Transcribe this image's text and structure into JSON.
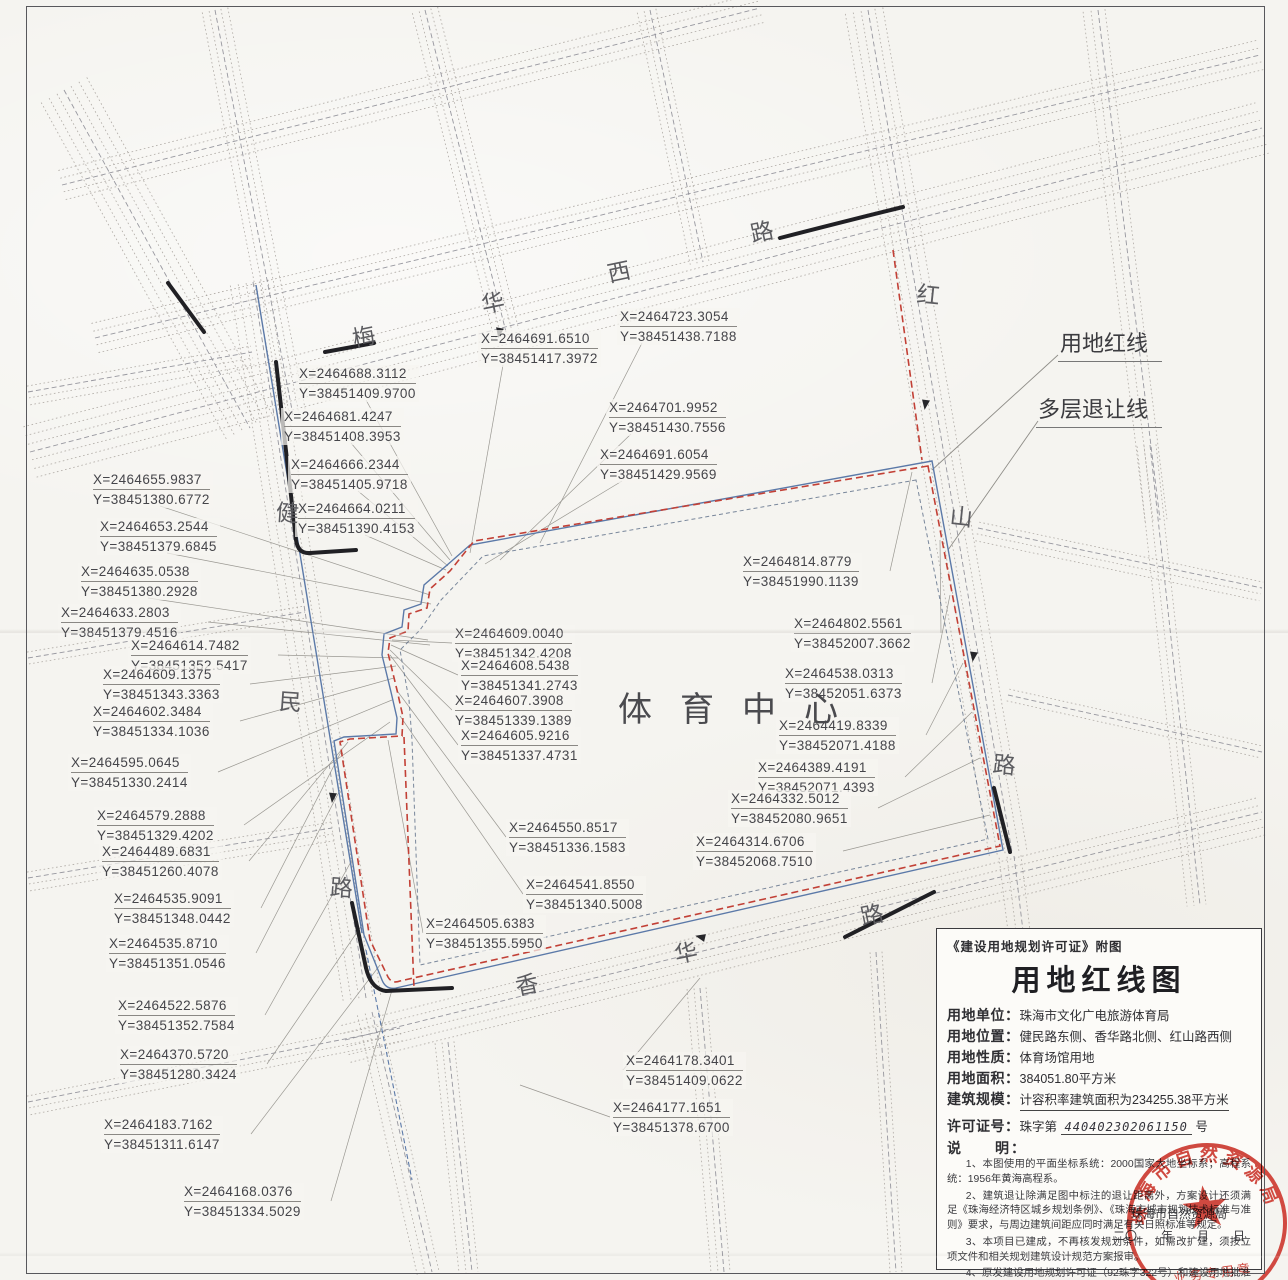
{
  "colors": {
    "red_line": "#c24036",
    "setback_line": "#5a6b86",
    "blue_line": "#5b79a8",
    "road_line": "#a39d98",
    "ink": "#45454a",
    "stamp_red": "#cc3127",
    "paper": "#f5f4f0"
  },
  "map": {
    "site_label": "体育中心",
    "road_names": {
      "top": "梅华西路",
      "left": "健民路",
      "right": "红山路",
      "bottom": "香华路"
    },
    "callouts": [
      {
        "text": "用地红线",
        "x": 1058,
        "y": 326
      },
      {
        "text": "多层退让线",
        "x": 1036,
        "y": 392
      }
    ],
    "road_chars": [
      {
        "ch": "梅",
        "x": 352,
        "y": 318,
        "r": -12
      },
      {
        "ch": "华",
        "x": 481,
        "y": 284,
        "r": -12
      },
      {
        "ch": "西",
        "x": 607,
        "y": 253,
        "r": -12
      },
      {
        "ch": "路",
        "x": 750,
        "y": 213,
        "r": -12
      },
      {
        "ch": "红",
        "x": 917,
        "y": 276,
        "r": 6
      },
      {
        "ch": "山",
        "x": 950,
        "y": 498,
        "r": 6
      },
      {
        "ch": "路",
        "x": 993,
        "y": 746,
        "r": 6
      },
      {
        "ch": "健",
        "x": 276,
        "y": 494,
        "r": 4
      },
      {
        "ch": "民",
        "x": 279,
        "y": 683,
        "r": 4
      },
      {
        "ch": "路",
        "x": 330,
        "y": 869,
        "r": 4
      },
      {
        "ch": "香",
        "x": 515,
        "y": 966,
        "r": -12
      },
      {
        "ch": "华",
        "x": 674,
        "y": 934,
        "r": -12
      },
      {
        "ch": "路",
        "x": 860,
        "y": 896,
        "r": -12
      }
    ],
    "coords": [
      {
        "x": 617,
        "y": 308,
        "tx": 540,
        "ty": 543,
        "xl": "X=2464723.3054",
        "yl": "Y=38451438.7188"
      },
      {
        "x": 478,
        "y": 330,
        "tx": 470,
        "ty": 553,
        "xl": "X=2464691.6510",
        "yl": "Y=38451417.3972"
      },
      {
        "x": 296,
        "y": 365,
        "tx": 452,
        "ty": 556,
        "xl": "X=2464688.3112",
        "yl": "Y=38451409.9700"
      },
      {
        "x": 281,
        "y": 408,
        "tx": 450,
        "ty": 560,
        "xl": "X=2464681.4247",
        "yl": "Y=38451408.3953"
      },
      {
        "x": 606,
        "y": 399,
        "tx": 500,
        "ty": 560,
        "xl": "X=2464701.9952",
        "yl": "Y=38451430.7556"
      },
      {
        "x": 597,
        "y": 446,
        "tx": 485,
        "ty": 564,
        "xl": "X=2464691.6054",
        "yl": "Y=38451429.9569"
      },
      {
        "x": 288,
        "y": 456,
        "tx": 448,
        "ty": 566,
        "xl": "X=2464666.2344",
        "yl": "Y=38451405.9718"
      },
      {
        "x": 90,
        "y": 471,
        "tx": 430,
        "ty": 595,
        "xl": "X=2464655.9837",
        "yl": "Y=38451380.6772"
      },
      {
        "x": 295,
        "y": 500,
        "tx": 446,
        "ty": 570,
        "xl": "X=2464664.0211",
        "yl": "Y=38451390.4153"
      },
      {
        "x": 97,
        "y": 518,
        "tx": 431,
        "ty": 604,
        "xl": "X=2464653.2544",
        "yl": "Y=38451379.6845"
      },
      {
        "x": 78,
        "y": 563,
        "tx": 428,
        "ty": 640,
        "xl": "X=2464635.0538",
        "yl": "Y=38451380.2928"
      },
      {
        "x": 58,
        "y": 604,
        "tx": 430,
        "ty": 645,
        "xl": "X=2464633.2803",
        "yl": "Y=38451379.4516"
      },
      {
        "x": 128,
        "y": 637,
        "tx": 398,
        "ty": 658,
        "xl": "X=2464614.7482",
        "yl": "Y=38451352.5417"
      },
      {
        "x": 100,
        "y": 666,
        "tx": 396,
        "ty": 666,
        "xl": "X=2464609.1375",
        "yl": "Y=38451343.3363"
      },
      {
        "x": 90,
        "y": 703,
        "tx": 394,
        "ty": 678,
        "xl": "X=2464602.3484",
        "yl": "Y=38451334.1036"
      },
      {
        "x": 68,
        "y": 754,
        "tx": 392,
        "ty": 700,
        "xl": "X=2464595.0645",
        "yl": "Y=38451330.2414"
      },
      {
        "x": 94,
        "y": 807,
        "tx": 390,
        "ty": 722,
        "xl": "X=2464579.2888",
        "yl": "Y=38451329.4202"
      },
      {
        "x": 99,
        "y": 843,
        "tx": 348,
        "ty": 742,
        "xl": "X=2464489.6831",
        "yl": "Y=38451260.4078"
      },
      {
        "x": 111,
        "y": 890,
        "tx": 342,
        "ty": 750,
        "xl": "X=2464535.9091",
        "yl": "Y=38451348.0442"
      },
      {
        "x": 106,
        "y": 935,
        "tx": 340,
        "ty": 790,
        "xl": "X=2464535.8710",
        "yl": "Y=38451351.0546"
      },
      {
        "x": 115,
        "y": 997,
        "tx": 352,
        "ty": 860,
        "xl": "X=2464522.5876",
        "yl": "Y=38451352.7584"
      },
      {
        "x": 117,
        "y": 1046,
        "tx": 362,
        "ty": 925,
        "xl": "X=2464370.5720",
        "yl": "Y=38451280.3424"
      },
      {
        "x": 101,
        "y": 1116,
        "tx": 380,
        "ty": 965,
        "xl": "X=2464183.7162",
        "yl": "Y=38451311.6147"
      },
      {
        "x": 181,
        "y": 1183,
        "tx": 392,
        "ty": 990,
        "xl": "X=2464168.0376",
        "yl": "Y=38451334.5029"
      },
      {
        "x": 452,
        "y": 625,
        "tx": 392,
        "ty": 640,
        "xl": "X=2464609.0040",
        "yl": "Y=38451342.4208"
      },
      {
        "x": 458,
        "y": 657,
        "tx": 391,
        "ty": 645,
        "xl": "X=2464608.5438",
        "yl": "Y=38451341.2743"
      },
      {
        "x": 452,
        "y": 692,
        "tx": 390,
        "ty": 650,
        "xl": "X=2464607.3908",
        "yl": "Y=38451339.1389"
      },
      {
        "x": 458,
        "y": 727,
        "tx": 390,
        "ty": 655,
        "xl": "X=2464605.9216",
        "yl": "Y=38451337.4731"
      },
      {
        "x": 506,
        "y": 819,
        "tx": 398,
        "ty": 692,
        "xl": "X=2464550.8517",
        "yl": "Y=38451336.1583"
      },
      {
        "x": 523,
        "y": 876,
        "tx": 400,
        "ty": 716,
        "xl": "X=2464541.8550",
        "yl": "Y=38451340.5008"
      },
      {
        "x": 423,
        "y": 915,
        "tx": 388,
        "ty": 740,
        "xl": "X=2464505.6383",
        "yl": "Y=38451355.5950"
      },
      {
        "x": 740,
        "y": 553,
        "tx": 912,
        "ty": 472,
        "xl": "X=2464814.8779",
        "yl": "Y=38451990.1139"
      },
      {
        "x": 791,
        "y": 615,
        "tx": 940,
        "ty": 540,
        "xl": "X=2464802.5561",
        "yl": "Y=38452007.3662"
      },
      {
        "x": 782,
        "y": 665,
        "tx": 950,
        "ty": 595,
        "xl": "X=2464538.0313",
        "yl": "Y=38452051.6373"
      },
      {
        "x": 776,
        "y": 717,
        "tx": 963,
        "ty": 663,
        "xl": "X=2464419.8339",
        "yl": "Y=38452071.4188"
      },
      {
        "x": 755,
        "y": 759,
        "tx": 972,
        "ty": 712,
        "xl": "X=2464389.4191",
        "yl": "Y=38452071.4393"
      },
      {
        "x": 728,
        "y": 790,
        "tx": 980,
        "ty": 758,
        "xl": "X=2464332.5012",
        "yl": "Y=38452080.9651"
      },
      {
        "x": 693,
        "y": 833,
        "tx": 990,
        "ty": 815,
        "xl": "X=2464314.6706",
        "yl": "Y=38452068.7510"
      },
      {
        "x": 623,
        "y": 1052,
        "tx": 700,
        "ty": 978,
        "xl": "X=2464178.3401",
        "yl": "Y=38451409.0622"
      },
      {
        "x": 610,
        "y": 1099,
        "tx": 520,
        "ty": 1085,
        "xl": "X=2464177.1651",
        "yl": "Y=38451378.6700"
      }
    ]
  },
  "legend": {
    "header_note": "《建设用地规划许可证》附图",
    "title": "用地红线图",
    "fields": [
      {
        "label": "用地单位：",
        "value": "珠海市文化广电旅游体育局",
        "underline": false
      },
      {
        "label": "用地位置：",
        "value": "健民路东侧、香华路北侧、红山路西侧",
        "underline": false
      },
      {
        "label": "用地性质：",
        "value": "体育场馆用地",
        "underline": false
      },
      {
        "label": "用地面积：",
        "value": "384051.80平方米",
        "underline": false
      },
      {
        "label": "建筑规模：",
        "value": "计容积率建筑面积为234255.38平方米",
        "underline": true
      }
    ],
    "permit": {
      "label": "许可证号：",
      "prefix": "珠字第",
      "number": "440402302061150",
      "suffix": "号"
    },
    "notes_label": "说　　明：",
    "notes": [
      "1、本图使用的平面坐标系统：2000国家大地坐标系；高程系统：1956年黄海高程系。",
      "2、建筑退让除满足图中标注的退让距离外，方案设计还须满足《珠海经济特区城乡规划条例》、《珠海市城市规划技术标准与准则》要求，与周边建筑间距应同时满足有关日照标准等规定。",
      "3、本项目已建成，不再核发规划条件，如需改扩建，须按立项文件和相关规划建筑设计规范方案报审。",
      "4、原发建设用地规划许可证（92珠字322号）和建设用地批准书（（1992）许字第72号）及其附图附件作废。"
    ],
    "issuer": "珠海市自然资源局",
    "date_line": "二〇　　年　　月　　日"
  },
  "stamp": {
    "arc_text": "珠海市自然资源局",
    "bottom_text": "业务专用章",
    "star": "★"
  }
}
